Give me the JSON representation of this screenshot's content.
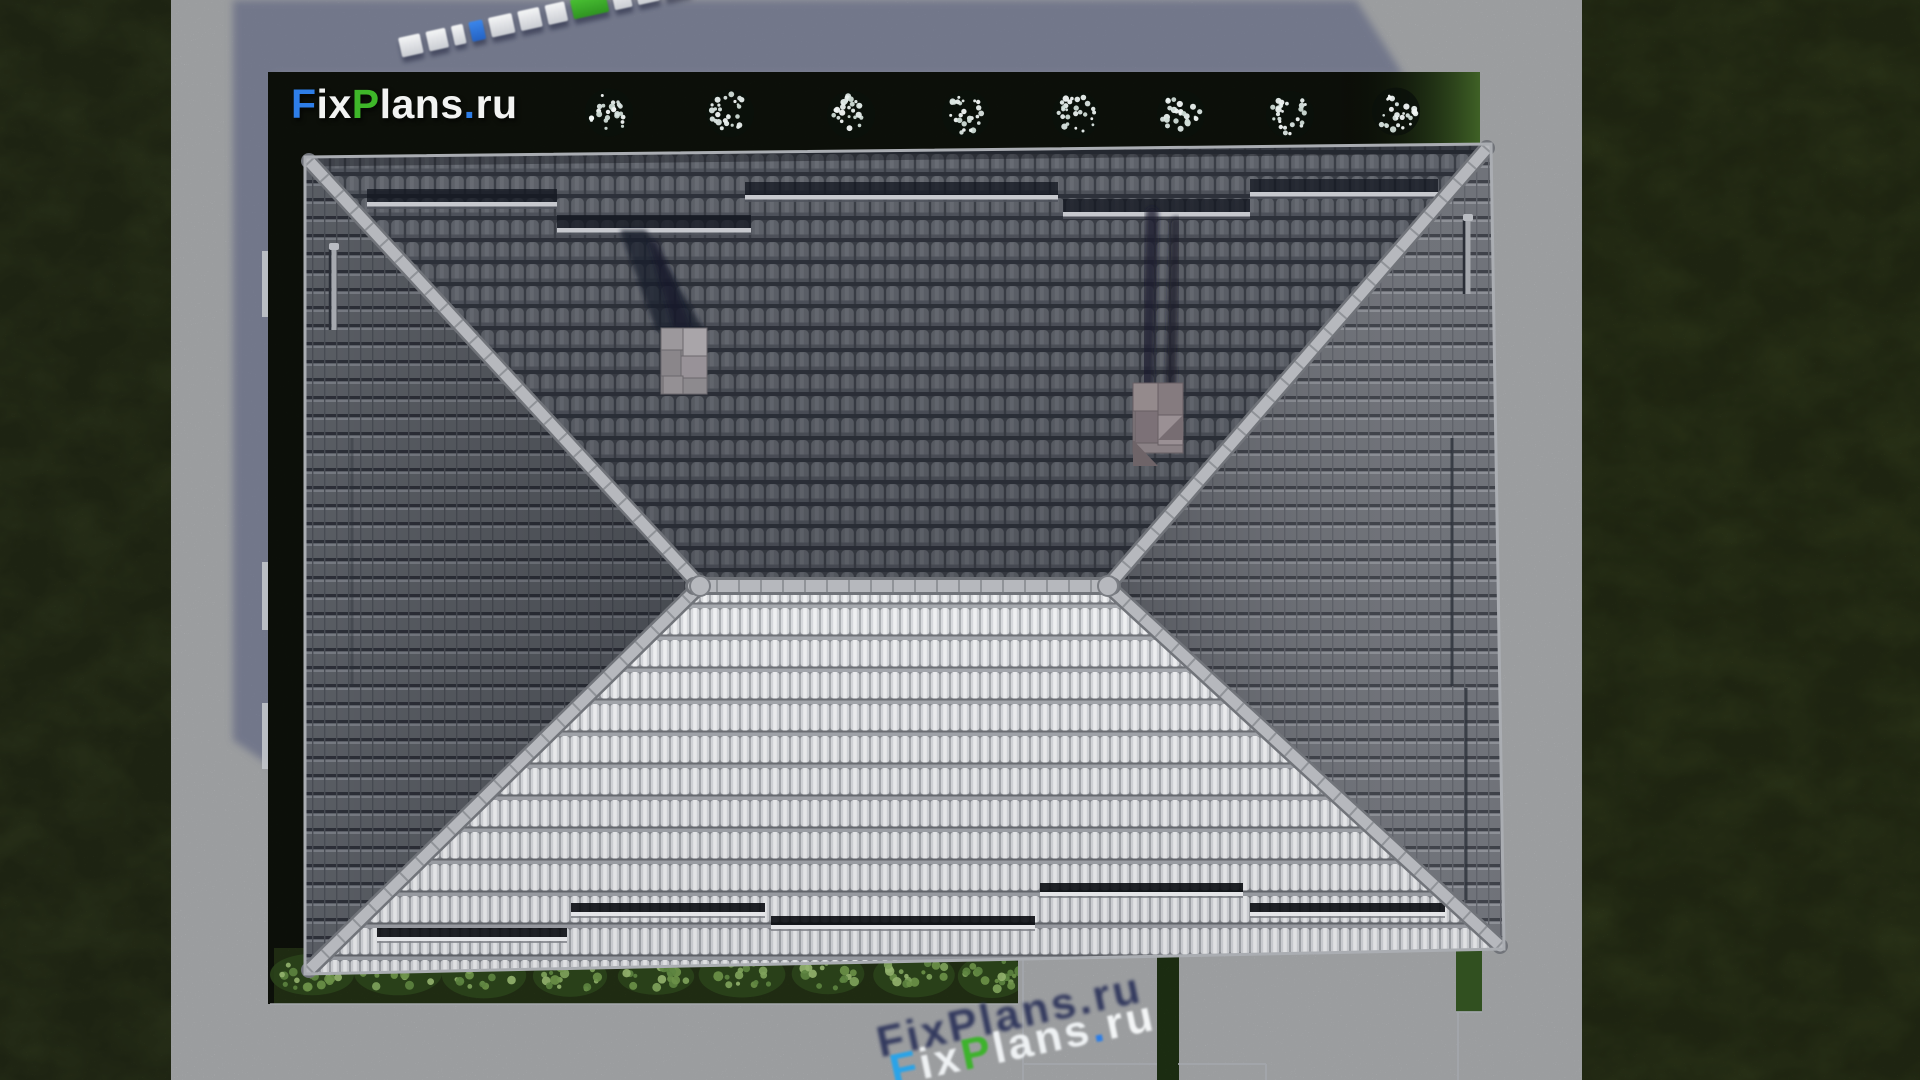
{
  "brand": {
    "name": "FixPlans.ru",
    "segments": [
      {
        "text": "F",
        "color": "#2e7ee8"
      },
      {
        "text": "ix",
        "color": "#f2f3f2"
      },
      {
        "text": "P",
        "color": "#3eb629"
      },
      {
        "text": "lans",
        "color": "#f2f3f2"
      },
      {
        "text": ".",
        "color": "#2e7ee8"
      },
      {
        "text": "ru",
        "color": "#f2f3f2"
      }
    ]
  },
  "watermark_bottom": {
    "text": "FixPlans.ru",
    "segments": [
      {
        "text": "F",
        "color": "#2aa3e8"
      },
      {
        "text": "ix",
        "color": "#eef1f3"
      },
      {
        "text": "P",
        "color": "#3db32c"
      },
      {
        "text": "lans",
        "color": "#eef1f3"
      },
      {
        "text": ".",
        "color": "#2a7de8"
      },
      {
        "text": "ru",
        "color": "#f3f5f6"
      }
    ]
  },
  "palette": {
    "pavement": "#c8cacd",
    "pavement_shadow": "#8f94ad",
    "grass_left": "#4d5c30",
    "grass_right": "#4f5f2d",
    "hedge_dark": "#161d11",
    "hedge_lit": "#3f6126",
    "lawn_strip": "#35491f",
    "shrub_green": "#6f9150",
    "blossom_white": "#e9f0ee",
    "roof_dark_tile": "#666a72",
    "roof_light_tile": "#d4d6da",
    "roof_side_tile": "#5d6168",
    "ridge_cap": "#b6b8bd",
    "chimney_gray": "#948f93",
    "shadow_navy": "#181c2b"
  },
  "counts": {
    "flower_bushes": 8,
    "green_shrubs": 9,
    "chimneys": 2,
    "snow_guards_north": 5,
    "snow_guards_south": 5
  },
  "view": "top-down aerial render of hip-roof house"
}
